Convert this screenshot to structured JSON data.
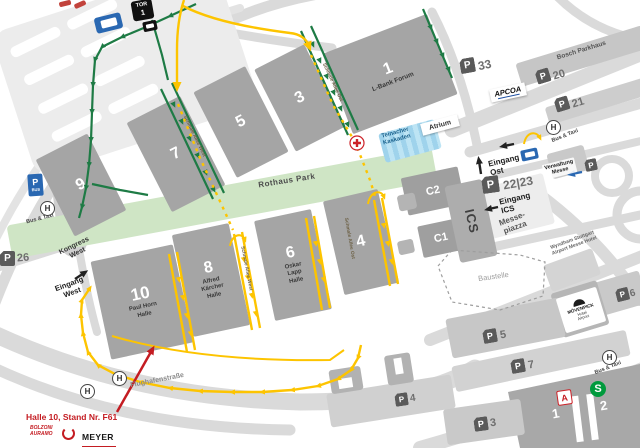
{
  "signs": {
    "tor_label": "TOR",
    "tor_number": "1",
    "p_letter": "P",
    "p_bus": "BUS"
  },
  "halls": {
    "h1": {
      "num": "1"
    },
    "h3": {
      "num": "3"
    },
    "h5": {
      "num": "5"
    },
    "h7": {
      "num": "7"
    },
    "h9": {
      "num": "9"
    },
    "h10": {
      "num": "10"
    },
    "h8": {
      "num": "8"
    },
    "h6": {
      "num": "6"
    },
    "h4": {
      "num": "4"
    },
    "c1": {
      "num": "C1"
    },
    "c2": {
      "num": "C2"
    }
  },
  "pois": {
    "lbank": "L-Bank Forum",
    "paul_horn_line1": "Paul Horn",
    "paul_horn_line2": "Halle",
    "kaercher_line1": "Alfred",
    "kaercher_line2": "Kärcher",
    "kaercher_line3": "Halle",
    "oskar_line1": "Oskar",
    "oskar_line2": "Lapp",
    "oskar_line3": "Halle",
    "bosch": "Bosch Parkhaus",
    "apcoa": "APCOA",
    "verwaltung_line1": "Verwaltung",
    "verwaltung_line2": "Messe",
    "wyndham_line1": "Wyndham Stuttgart",
    "wyndham_line2": "Airport Messe Hotel",
    "moevenpick_line1": "MÖVENPICK",
    "moevenpick_line2": "Hotel",
    "moevenpick_line3": "Airport"
  },
  "areas": {
    "rothaus_park": "Rothaus Park",
    "teinacher_line1": "Teinacher",
    "teinacher_line2": "Kaskaden",
    "atrium": "Atrium",
    "baustelle": "Baustelle",
    "messepiazza_line1": "Messe-",
    "messepiazza_line2": "piazza",
    "ics": "ICS"
  },
  "streets": {
    "allee_west": "Schmale Allee West",
    "allee_ost": "Schmale Allee Ost",
    "flughafenstrasse": "Flughafenstraße"
  },
  "entrances": {
    "ost_line1": "Eingang",
    "ost_line2": "Ost",
    "ics_line1": "Eingang",
    "ics_line2": "ICS",
    "west_line1": "Eingang",
    "west_line2": "West",
    "kongress_line1": "Kongress",
    "kongress_line2": "West"
  },
  "parking": {
    "p33": "33",
    "p20": "20",
    "p21": "21",
    "p22_23": "22|23",
    "p26": "26",
    "p3": "3",
    "p4": "4",
    "p5": "5",
    "p6": "6",
    "p7": "7"
  },
  "transit": {
    "bus_taxi": "Bus & Taxi",
    "h_stop": "H",
    "s_bahn": "S",
    "airport_a": "A",
    "platform1": "1",
    "platform2": "2"
  },
  "annotation": {
    "stand_note": "Halle 10, Stand Nr. F61",
    "logo_bolzoni_line1": "BOLZONI",
    "logo_bolzoni_line2": "AURAMO",
    "logo_meyer": "MEYER"
  },
  "colors": {
    "route_green": "#1e7b45",
    "route_yellow": "#fdc400",
    "accent_red": "#c41c22",
    "park_green": "#cfe5c5",
    "kaskaden_blue": "#a9d9ee",
    "sbahn_green": "#009a3d",
    "pbus_blue": "#2a68b2"
  }
}
